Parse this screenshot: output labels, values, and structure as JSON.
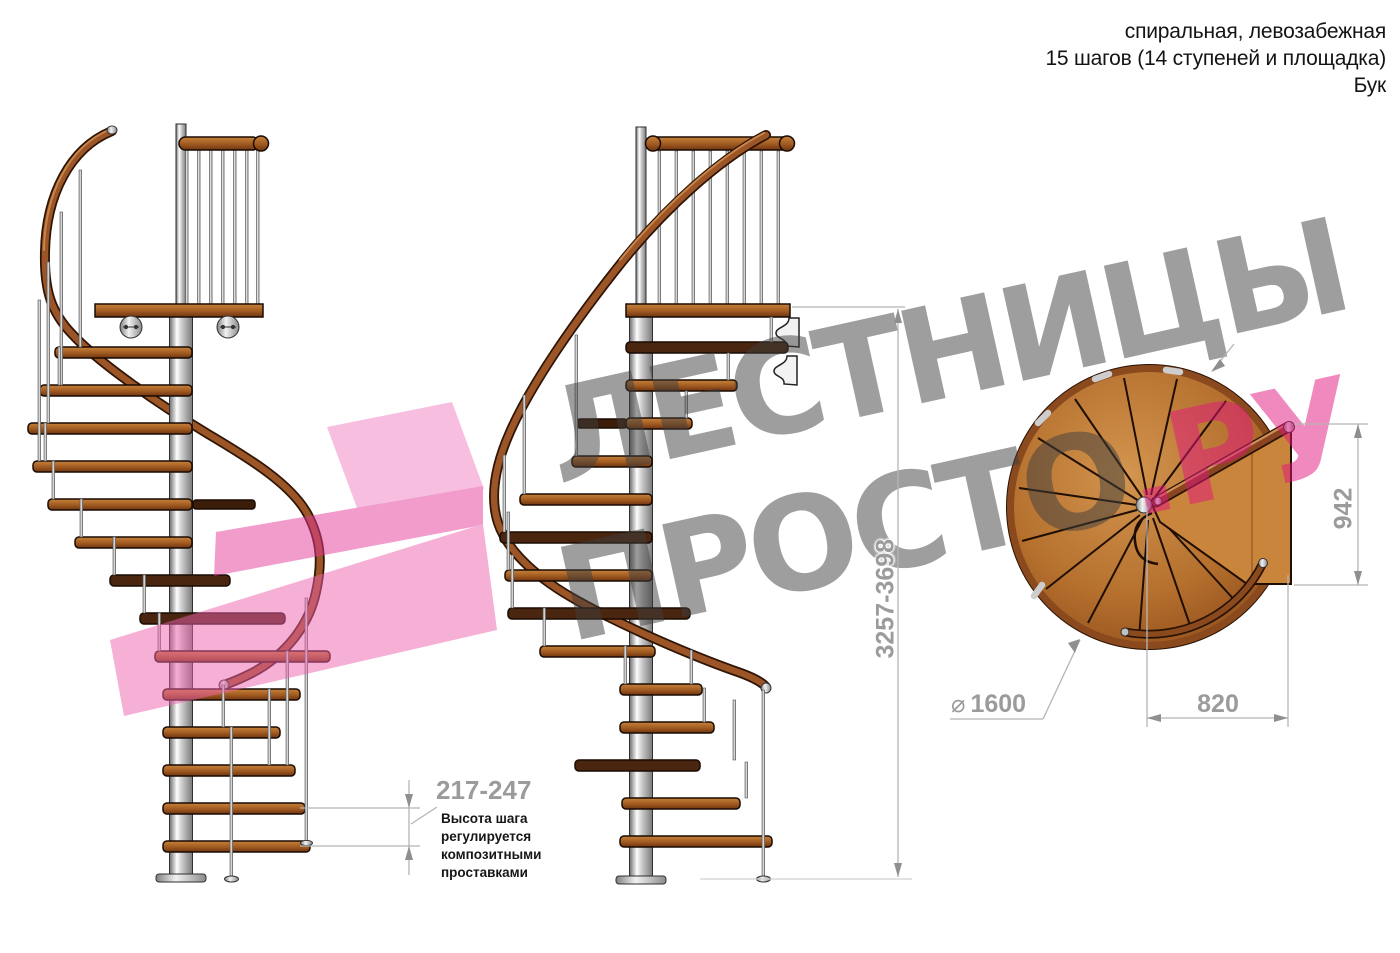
{
  "header": {
    "line1": "спиральная, левозабежная",
    "line2": "15 шагов (14 ступеней и площадка)",
    "line3": "Бук"
  },
  "dimensions": {
    "step_height": "217-247",
    "total_height": "3257-3698",
    "landing_height": "942",
    "landing_width": "820",
    "diameter_symbol": "⌀",
    "diameter": "1600"
  },
  "note": {
    "line1": "Высота шага",
    "line2": "регулируется",
    "line3": "композитными",
    "line4": "проставками"
  },
  "watermark": {
    "line1": "ЛЕСТНИЦЫ",
    "line2": "ПРОСТО",
    "suffix": ".РУ"
  },
  "colors": {
    "wood": "#a05a20",
    "steel": "#d9d9d9",
    "dimension_gray": "#9b9b9b",
    "watermark_gray": "#9a9a9a",
    "accent_pink": "#e3157f",
    "text_black": "#141414",
    "background": "#ffffff"
  }
}
